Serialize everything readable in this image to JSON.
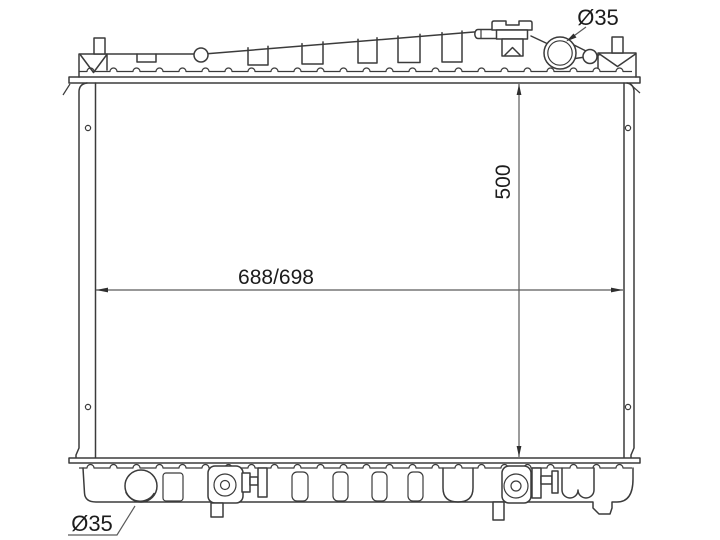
{
  "drawing": {
    "kind": "radiator-outline-technical-drawing",
    "labels": {
      "core_width": "688/698",
      "core_height": "500",
      "inlet_diameter": "Ø35",
      "outlet_diameter": "Ø35"
    },
    "colors": {
      "background": "#ffffff",
      "part_line": "#3b3b3b",
      "dimension_line": "#5a5a5a",
      "text": "#1c1c1c"
    }
  }
}
